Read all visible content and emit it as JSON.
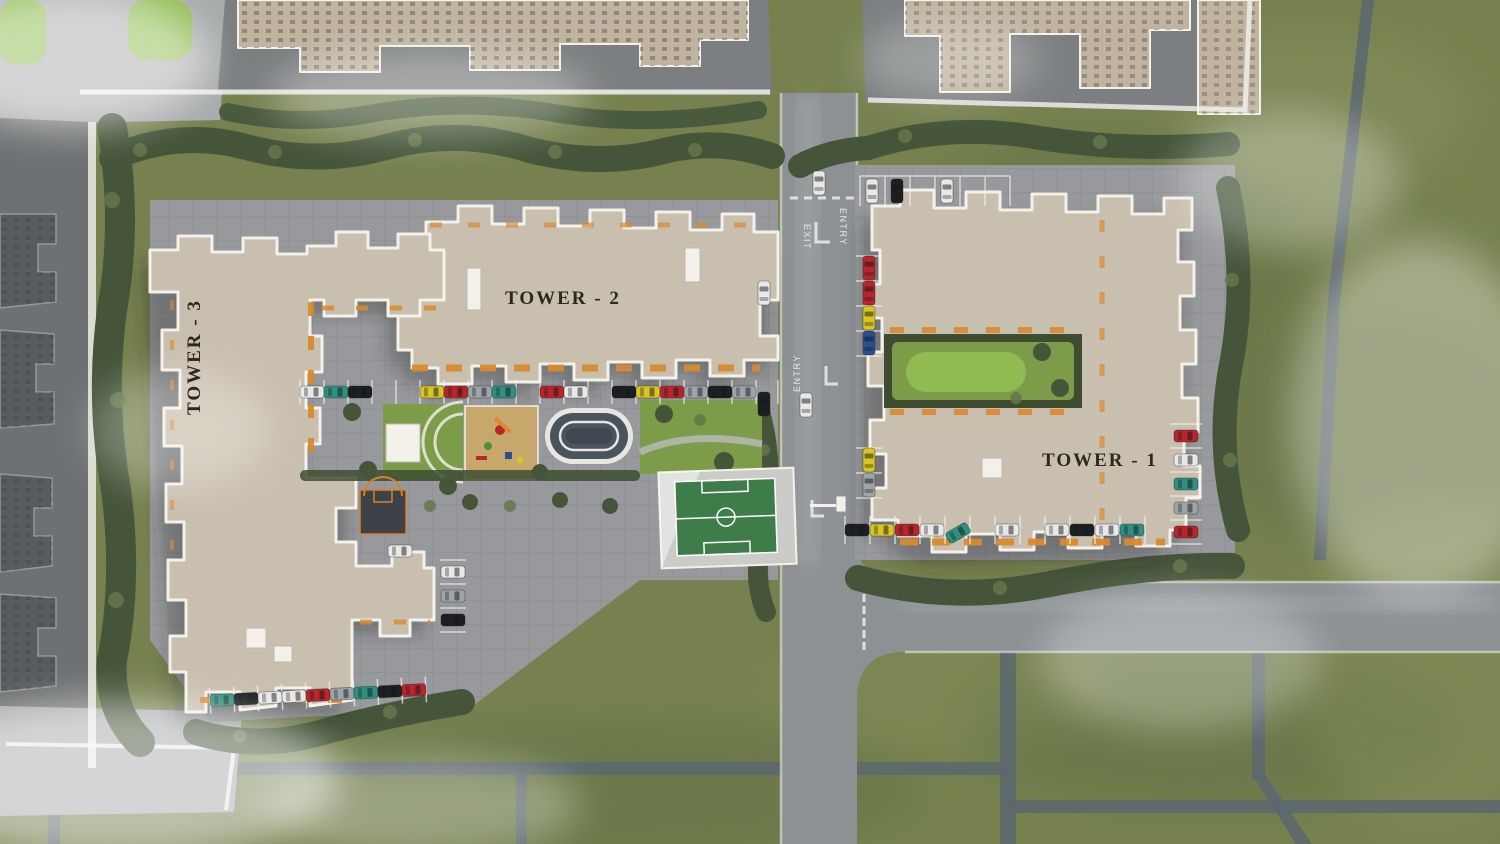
{
  "labels": {
    "tower_1": "TOWER - 1",
    "tower_2": "TOWER - 2",
    "tower_3": "TOWER - 3",
    "entry_top": "ENTRY",
    "exit_top": "EXIT",
    "entry_mid": "ENTRY"
  },
  "palette": {
    "grass": "#76814f",
    "grassDark": "#5a6840",
    "grassLight": "#8d9563",
    "tree": "#46553a",
    "treeLight": "#64774a",
    "roadMain": "#8d9194",
    "roadThin": "#5d686e",
    "pavement": "#97999c",
    "pavementLight": "#a8abac",
    "plotGray": "#7c7f81",
    "plotDark": "#6e7173",
    "neighborRoof": "#c0b4a0",
    "bldgDark": "#595c5e",
    "roof": "#c9bfae",
    "roofEdge": "#f3f1ea",
    "accent": "#d88a2f",
    "lawn": "#7c9c4a",
    "lawnBright": "#8fbb51",
    "hedge": "#3e4d31",
    "sand": "#c7a76c",
    "trackRing": "#e7e6e2",
    "trackBand": "#4a545c",
    "field": "#3e7c49",
    "court": "#3c4247",
    "courtLine": "#d87f2f",
    "lineWhite": "#f2f2ef",
    "labelDark": "#2e2721",
    "labelWhite": "#f0f0ec",
    "carRed": "#b8252a",
    "carYellow": "#d8c523",
    "carBlue": "#2a4f8f",
    "carWhite": "#e8e8e6",
    "carBlack": "#1d1f21",
    "carSilver": "#9fa4a8",
    "carTeal": "#2f9080"
  }
}
